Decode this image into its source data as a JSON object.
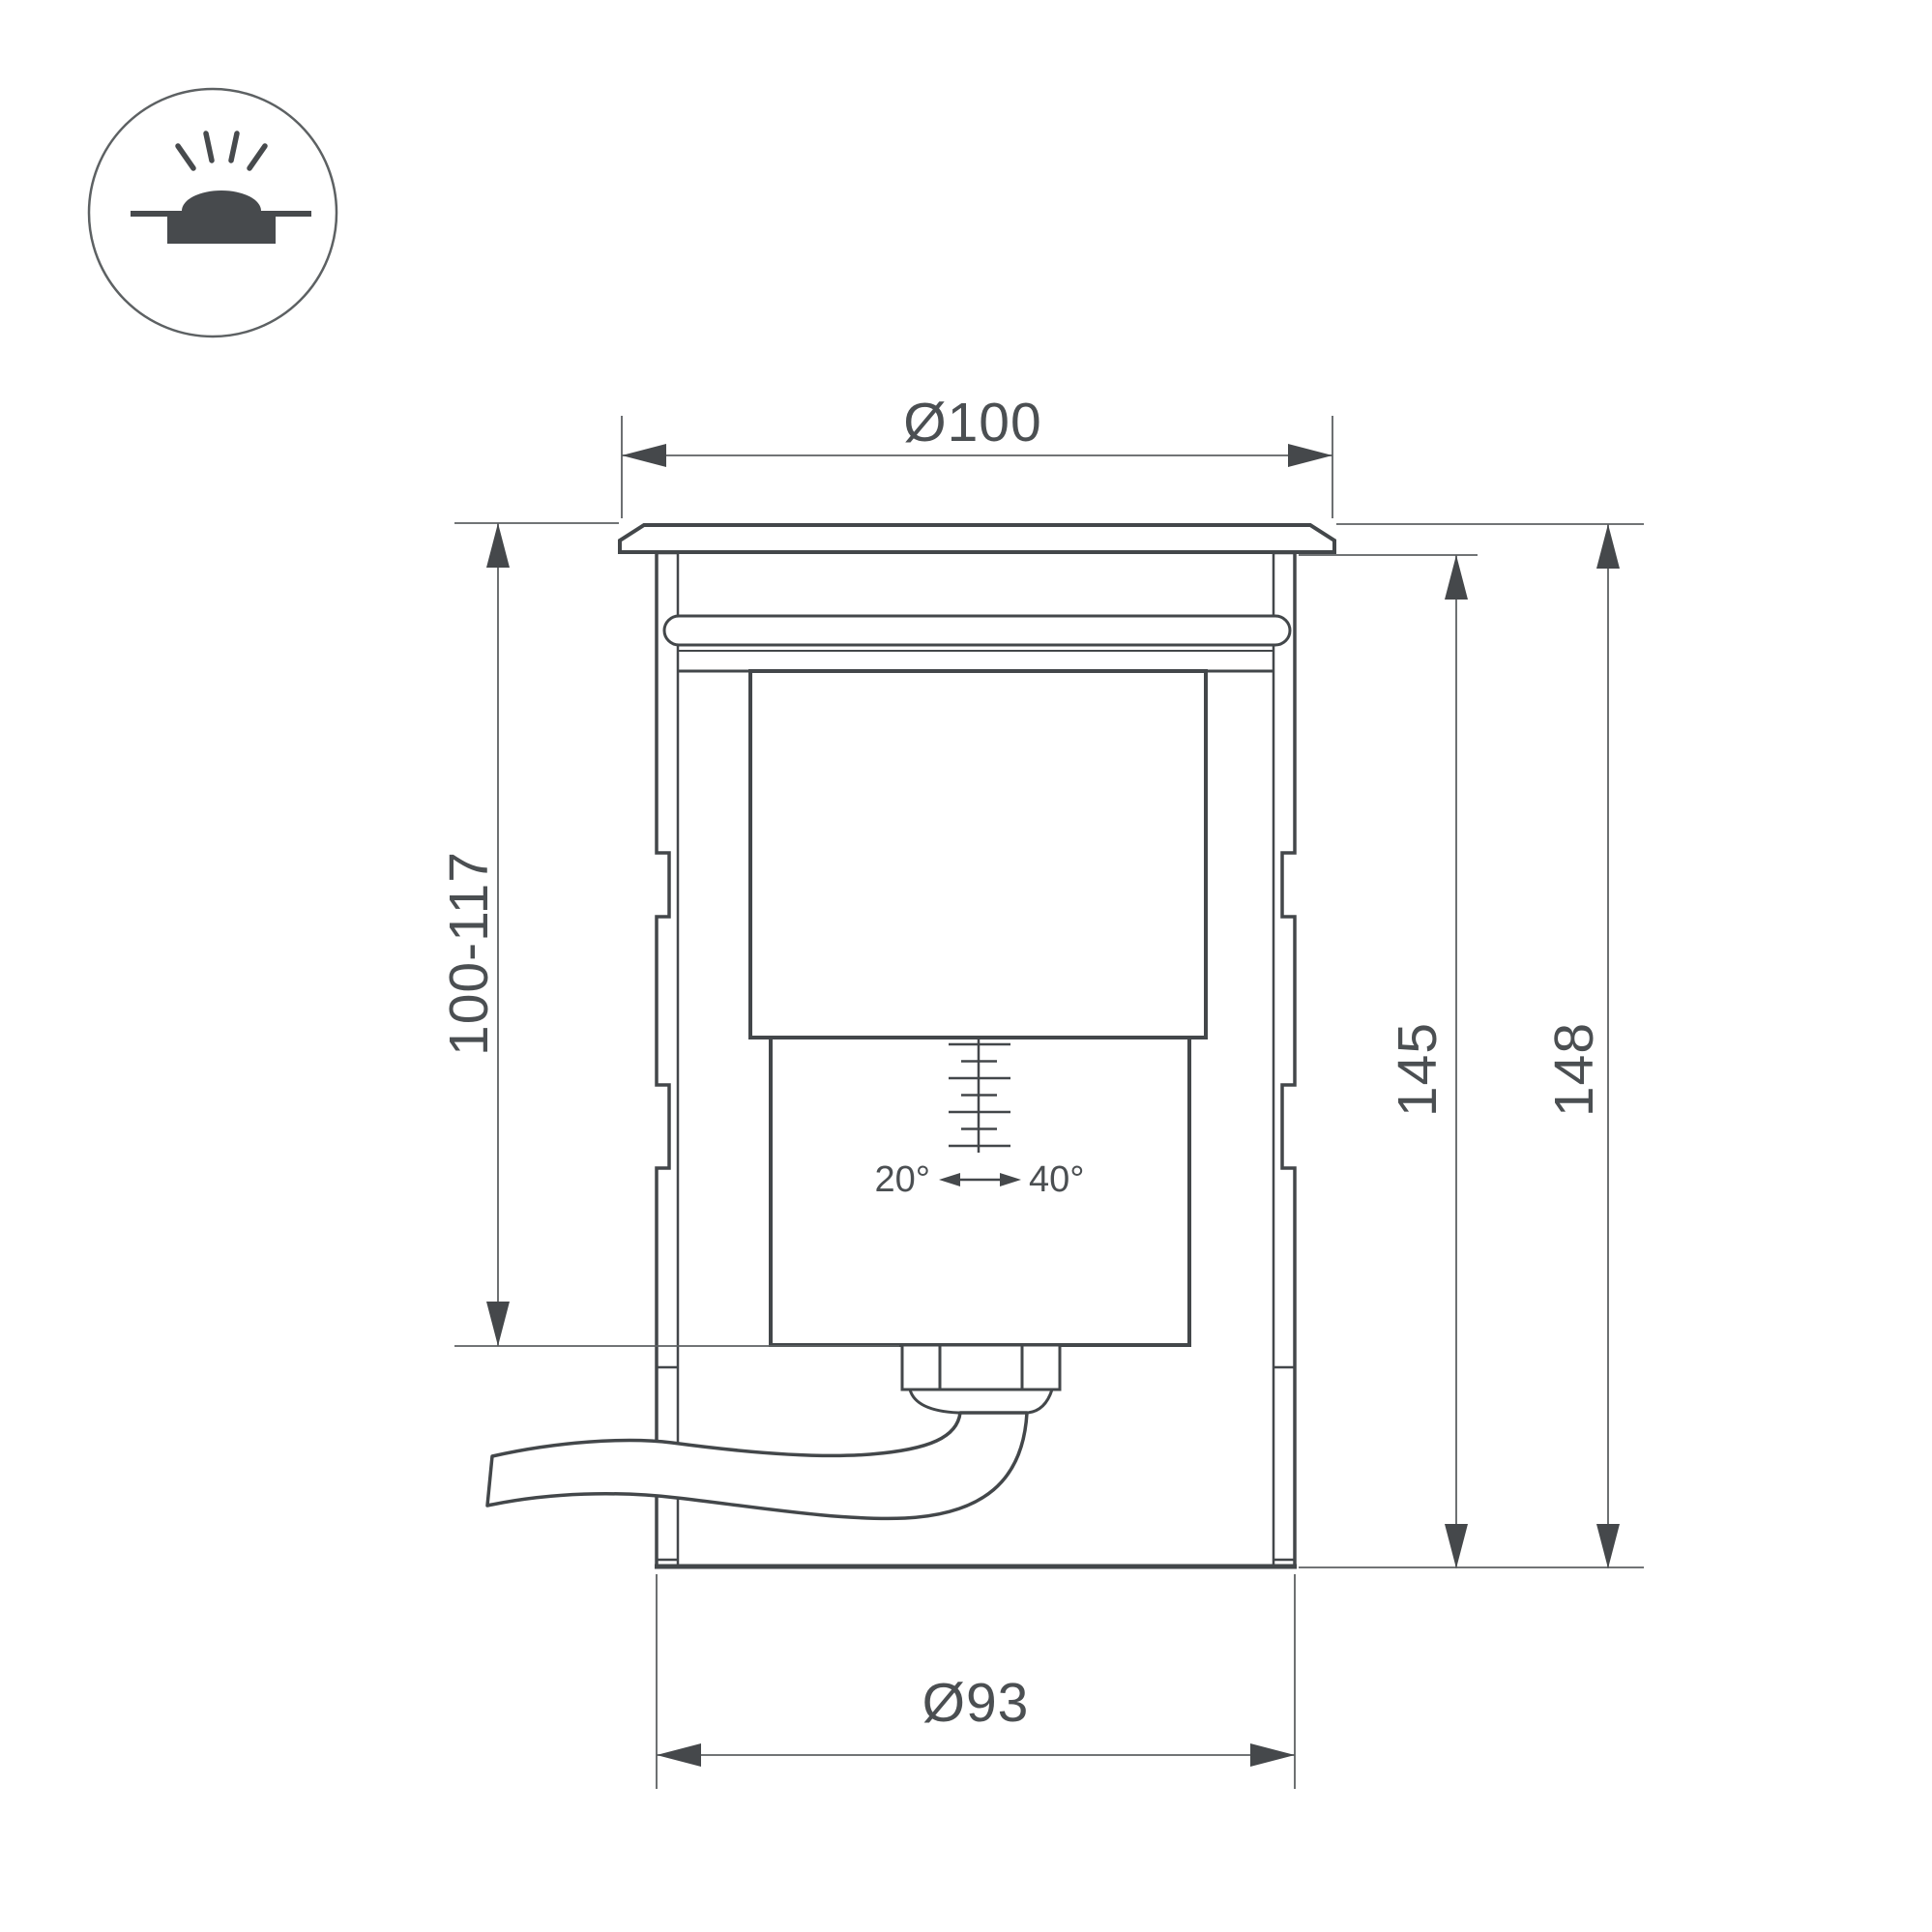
{
  "colors": {
    "ink": "#43474a",
    "thin_line": "#5d6163",
    "text": "#4b4f52",
    "background": "#ffffff"
  },
  "icons": [
    {
      "name": "recessed-ground-light-icon",
      "description": "half sun with rays over ground line and recessed body"
    }
  ],
  "dimensions": {
    "top_diameter": "Ø100",
    "embed_depth_range": "100-117",
    "height_inner": "145",
    "height_total": "148",
    "body_diameter": "Ø93",
    "tilt_min": "20°",
    "tilt_max": "40°"
  }
}
